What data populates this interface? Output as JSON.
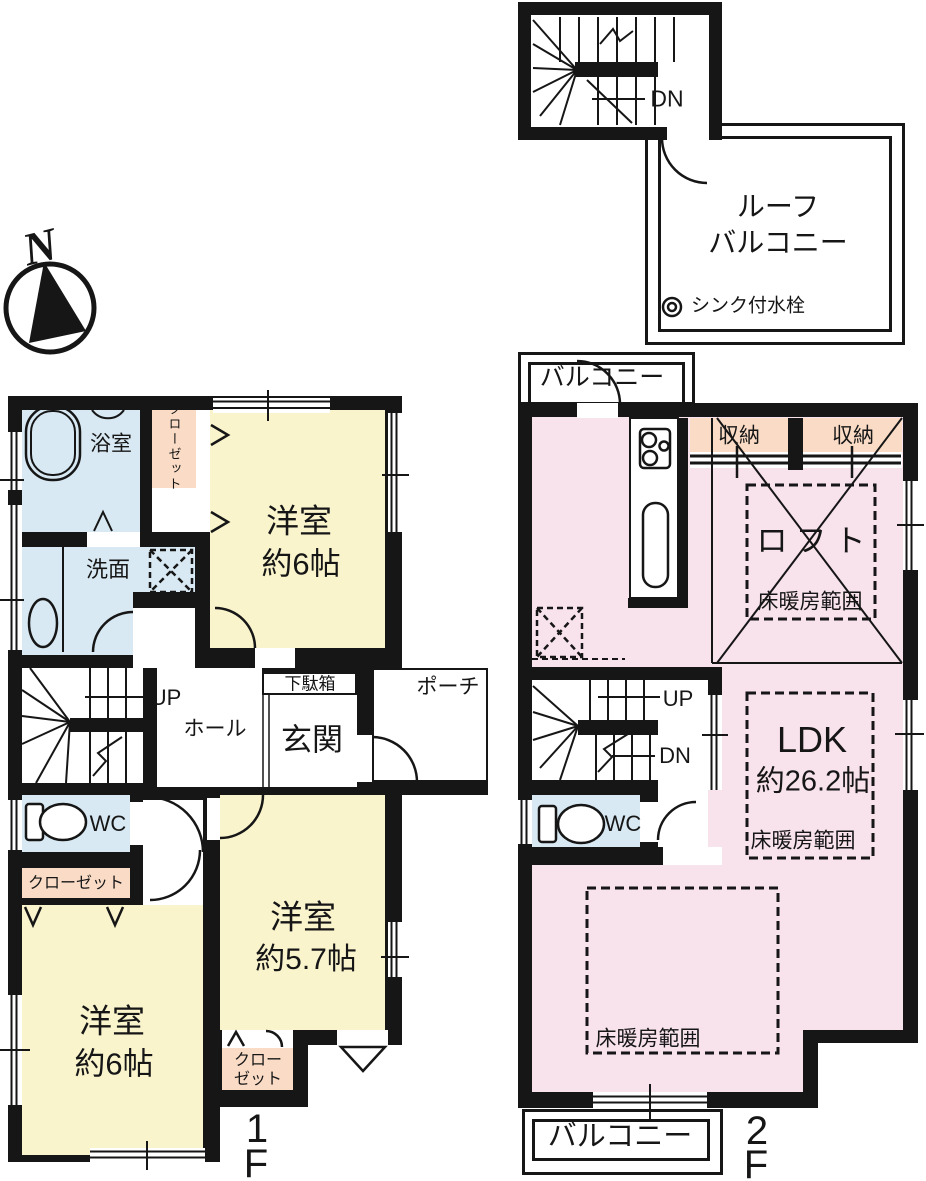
{
  "compass": {
    "n": "N"
  },
  "roof": {
    "dn": "DN",
    "balcony_line1": "ルーフ",
    "balcony_line2": "バルコニー",
    "sink_note": "シンク付水栓"
  },
  "f1": {
    "floor_num": "1",
    "floor_letter": "F",
    "bath": "浴室",
    "closet_north": "クローゼット",
    "room_ne_name": "洋室",
    "room_ne_size": "約6帖",
    "washroom": "洗面",
    "up": "UP",
    "hall": "ホール",
    "shoebox": "下駄箱",
    "entrance": "玄関",
    "porch": "ポーチ",
    "wc": "WC",
    "closet_west": "クローゼット",
    "room_sw_name": "洋室",
    "room_sw_size": "約6帖",
    "room_se_name": "洋室",
    "room_se_size": "約5.7帖",
    "closet_s_line1": "クロー",
    "closet_s_line2": "ゼット"
  },
  "f2": {
    "floor_num": "2",
    "floor_letter": "F",
    "balcony_top": "バルコニー",
    "balcony_bottom": "バルコニー",
    "storage_left": "収納",
    "storage_right": "収納",
    "loft": "ロフト",
    "ldk_name": "LDK",
    "ldk_size": "約26.2帖",
    "heating_loft": "床暖房範囲",
    "heating_mid": "床暖房範囲",
    "heating_south": "床暖房範囲",
    "up": "UP",
    "dn": "DN",
    "wc": "WC"
  },
  "colors": {
    "wall": "#161616",
    "line": "#161616",
    "room_yellow": "#faf4cd",
    "room_pink": "#f8e2ec",
    "room_peach": "#fadcc6",
    "room_blue": "#d8e9f3"
  }
}
